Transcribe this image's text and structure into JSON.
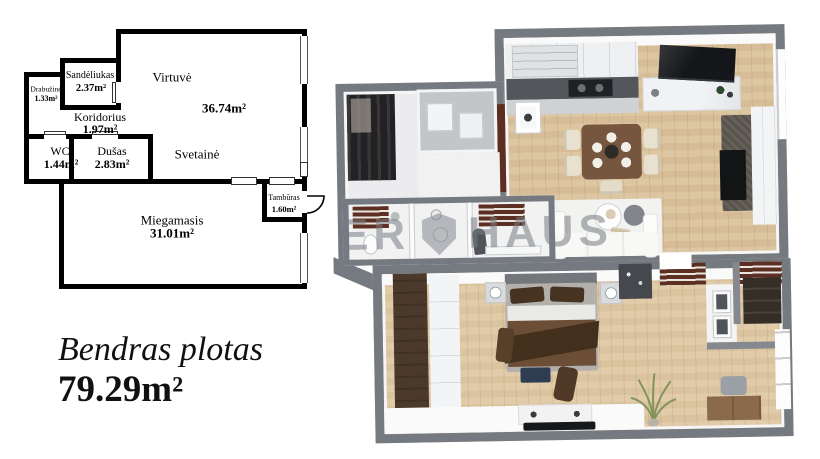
{
  "summary": {
    "label": "Bendras plotas",
    "value": "79.29m²"
  },
  "rooms": {
    "virtuve": {
      "name": "Virtuvė",
      "area": "36.74m²"
    },
    "svetaine": {
      "name": "Svetainė",
      "area": ""
    },
    "sandeliukas": {
      "name": "Sandėliukas",
      "area": "2.37m²"
    },
    "drabuzine": {
      "name": "Drabužinė",
      "area": "1.33m²"
    },
    "koridorius": {
      "name": "Koridorius",
      "area": "1.97m²"
    },
    "wc": {
      "name": "WC",
      "area": "1.44m²"
    },
    "dusas": {
      "name": "Dušas",
      "area": "2.83m²"
    },
    "miegamasis": {
      "name": "Miegamasis",
      "area": "31.01m²"
    },
    "tamburas": {
      "name": "Tambūras",
      "area": "1.60m²"
    }
  },
  "watermark": {
    "left": "ER",
    "right": "HAUS",
    "emblem": "shield-icon"
  },
  "colors": {
    "plan_walls": "#000000",
    "walls_3d": "#757a81",
    "floor_wood": "#dbc29c",
    "accent_panel": "#5d2f23",
    "watermark": "#767b82"
  }
}
